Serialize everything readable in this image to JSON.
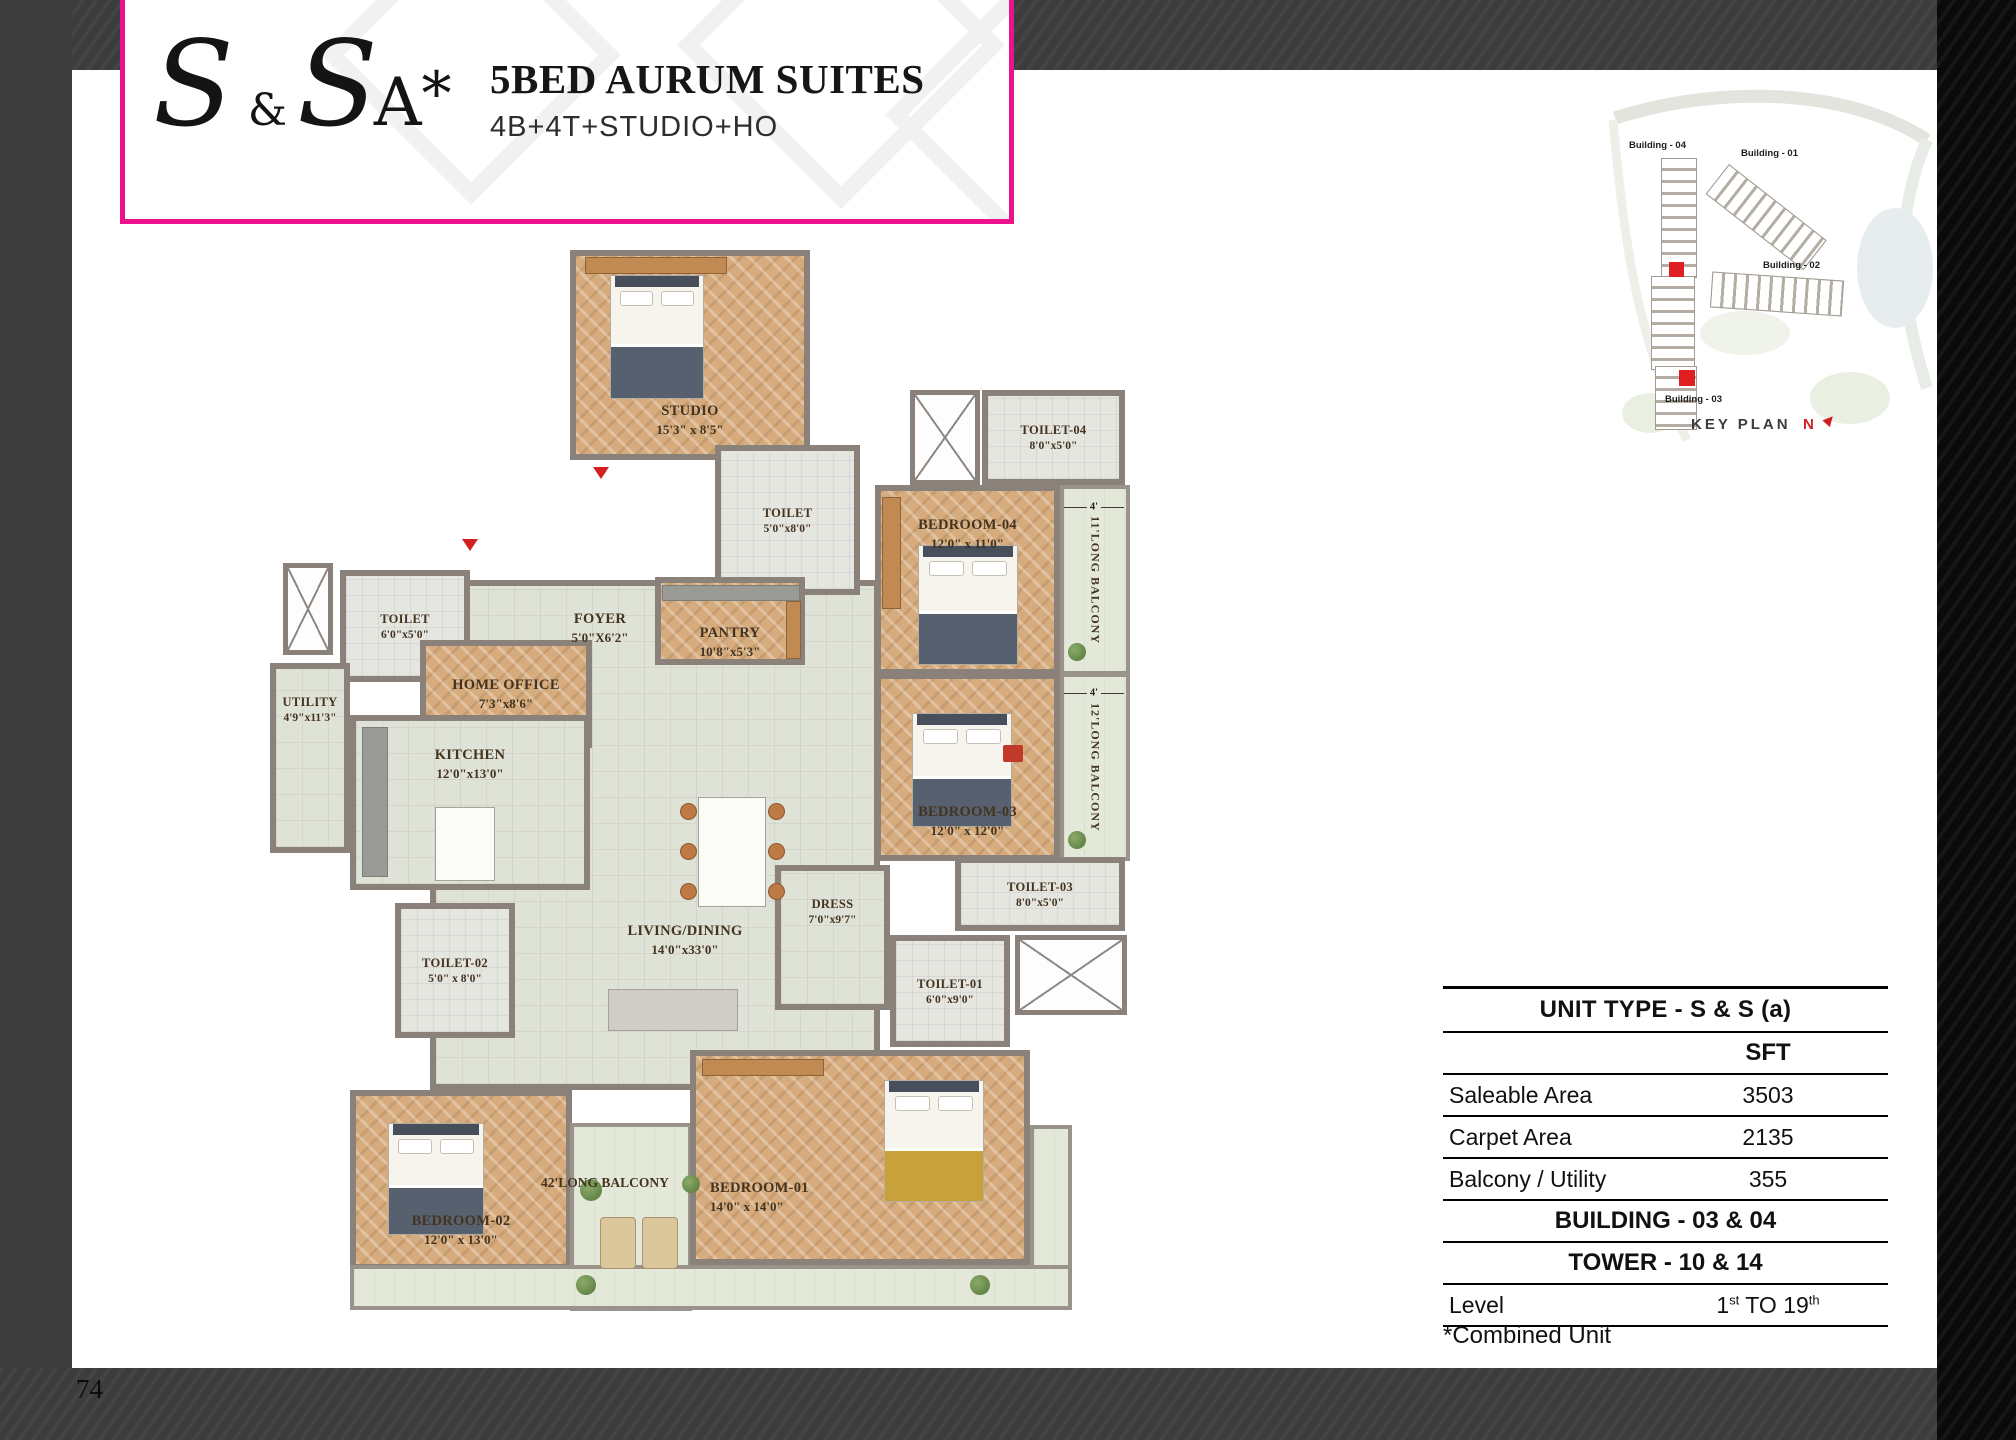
{
  "page": {
    "number": "74"
  },
  "header": {
    "logo": {
      "s1": "S",
      "amp": "&",
      "s2": "S",
      "a": "A",
      "star": "*"
    },
    "title": "5BED AURUM SUITES",
    "subtitle": "4B+4T+STUDIO+HO"
  },
  "keyplan": {
    "buildings": [
      {
        "label": "Building - 04"
      },
      {
        "label": "Building - 01"
      },
      {
        "label": "Building - 02"
      },
      {
        "label": "Building - 03"
      }
    ],
    "title": "KEY PLAN",
    "north": "N"
  },
  "floorplan": {
    "rooms": [
      {
        "name": "STUDIO",
        "dims": "15'3\" x 8'5\""
      },
      {
        "name": "TOILET",
        "dims": "5'0\"x8'0\""
      },
      {
        "name": "TOILET-04",
        "dims": "8'0\"x5'0\""
      },
      {
        "name": "BEDROOM-04",
        "dims": "12'0\" x 11'0\""
      },
      {
        "name": "FOYER",
        "dims": "5'0\"X6'2\""
      },
      {
        "name": "PANTRY",
        "dims": "10'8\"x5'3\""
      },
      {
        "name": "TOILET",
        "dims": "6'0\"x5'0\""
      },
      {
        "name": "HOME OFFICE",
        "dims": "7'3\"x8'6\""
      },
      {
        "name": "UTILITY",
        "dims": "4'9\"x11'3\""
      },
      {
        "name": "KITCHEN",
        "dims": "12'0\"x13'0\""
      },
      {
        "name": "BEDROOM-03",
        "dims": "12'0\" x 12'0\""
      },
      {
        "name": "TOILET-03",
        "dims": "8'0\"x5'0\""
      },
      {
        "name": "LIVING/DINING",
        "dims": "14'0\"x33'0\""
      },
      {
        "name": "DRESS",
        "dims": "7'0\"x9'7\""
      },
      {
        "name": "TOILET-01",
        "dims": "6'0\"x9'0\""
      },
      {
        "name": "TOILET-02",
        "dims": "5'0\" x 8'0\""
      },
      {
        "name": "BEDROOM-02",
        "dims": "12'0\" x 13'0\""
      },
      {
        "name": "BEDROOM-01",
        "dims": "14'0\" x 14'0\""
      }
    ],
    "balconies": [
      {
        "width": "4'",
        "label": "11'LONG BALCONY"
      },
      {
        "width": "4'",
        "label": "12'LONG BALCONY"
      },
      {
        "label": "42'LONG BALCONY"
      }
    ]
  },
  "table": {
    "title": "UNIT TYPE - S & S (a)",
    "col_header": "SFT",
    "rows": [
      {
        "label": "Saleable Area",
        "value": "3503"
      },
      {
        "label": "Carpet Area",
        "value": "2135"
      },
      {
        "label": "Balcony / Utility",
        "value": "355"
      }
    ],
    "building": "BUILDING - 03 & 04",
    "tower": "TOWER - 10 & 14",
    "level": {
      "label": "Level",
      "n1": "1",
      "s1": "st",
      "mid": " TO ",
      "n2": "19",
      "s2": "th"
    }
  },
  "footnote": "*Combined Unit",
  "colors": {
    "accent_pink": "#EC128C",
    "bar_dark": "#3D3C3C",
    "side_black": "#0A0A0A",
    "wall": "#8A817B",
    "wood_floor": "#D6AC7E",
    "tile_floor": "#DFE2D6",
    "balcony_floor": "#E3E8D9",
    "label_brown": "#43331F",
    "red": "#CF1F1F"
  }
}
